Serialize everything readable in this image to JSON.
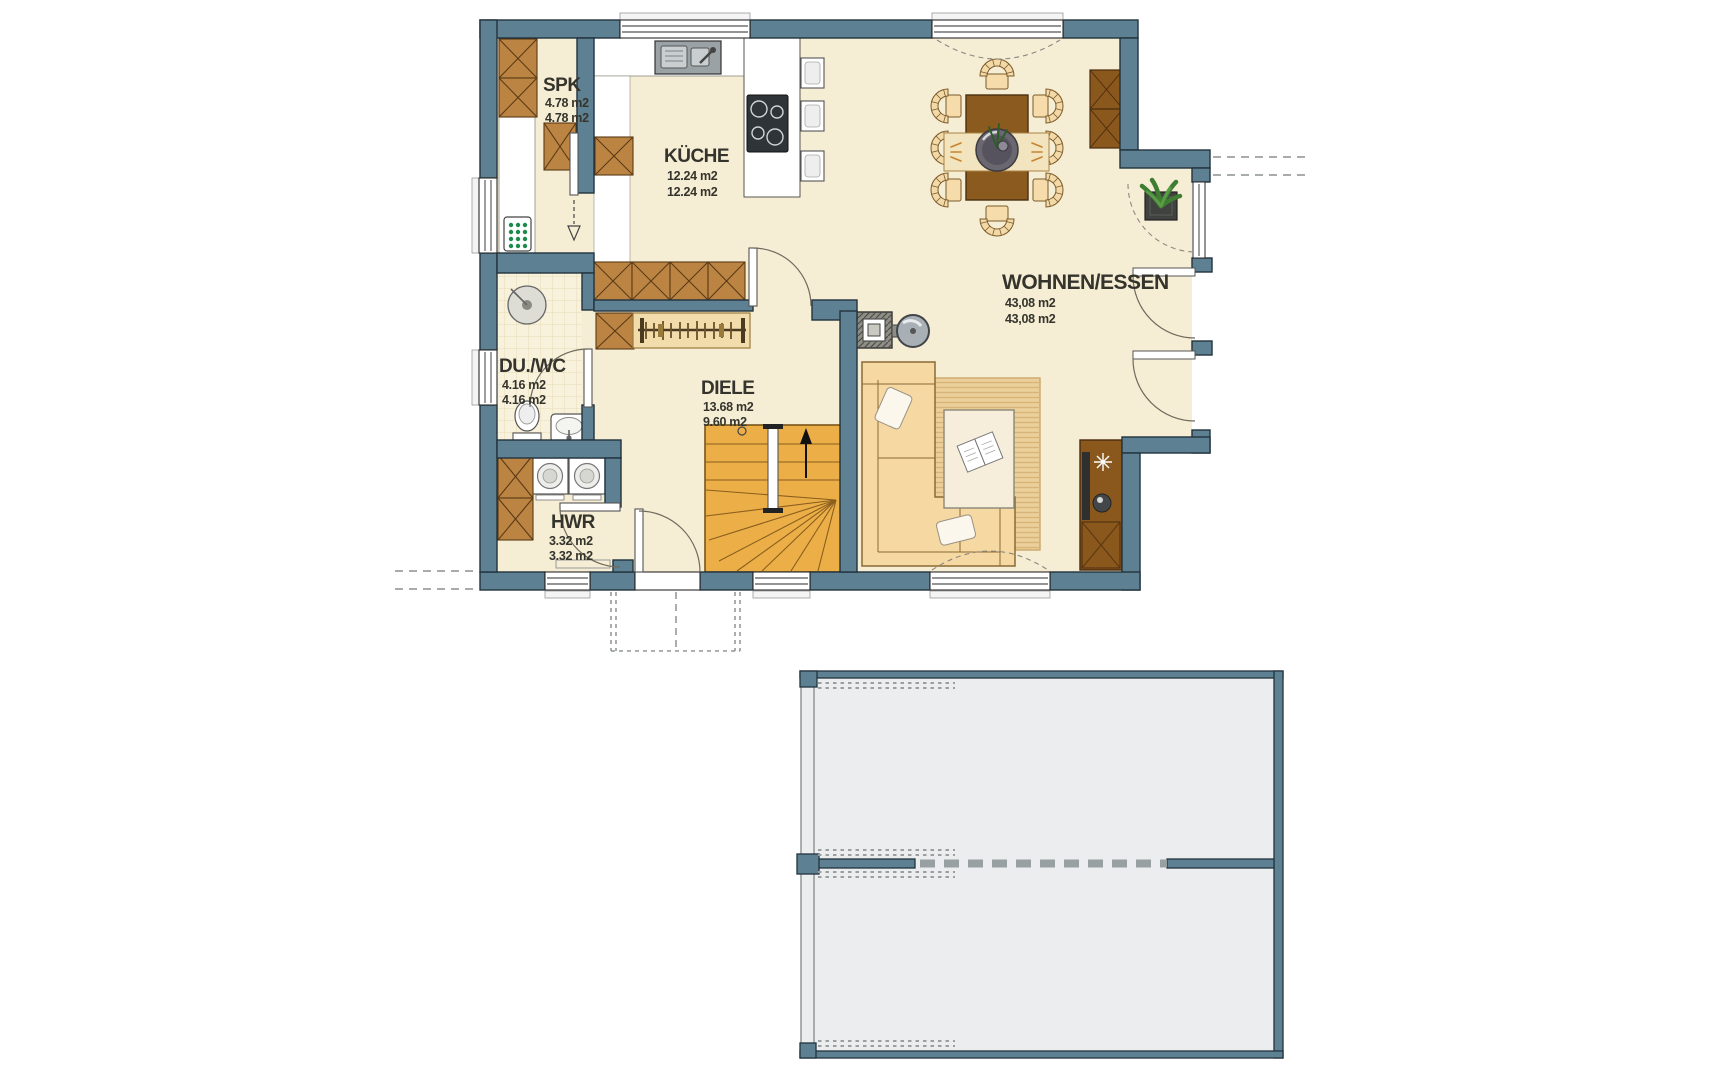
{
  "rooms": {
    "spk": {
      "name": "SPK",
      "area_line1": "4.78 m2",
      "area_line2": "4.78 m2"
    },
    "kueche": {
      "name": "KÜCHE",
      "area_line1": "12.24 m2",
      "area_line2": "12.24 m2"
    },
    "du_wc": {
      "name": "DU./WC",
      "area_line1": "4.16 m2",
      "area_line2": "4.16 m2"
    },
    "diele": {
      "name": "DIELE",
      "area_line1": "13.68 m2",
      "area_line2": "9.60 m2"
    },
    "hwr": {
      "name": "HWR",
      "area_line1": "3.32 m2",
      "area_line2": "3.32 m2"
    },
    "wohnen_essen": {
      "name": "WOHNEN/ESSEN",
      "area_line1": "43,08 m2",
      "area_line2": "43,08 m2"
    }
  },
  "colors": {
    "wall": "#5E8093",
    "outline": "#22333d",
    "floor": "#F6EDD5",
    "tile": "#F8F1DC",
    "kitchen_counter": "#FFFFFF",
    "wood_dark": "#8A5A1E",
    "wood_mid": "#BC8443",
    "soft_furniture": "#F6D8A3",
    "stairs": "#ECAF48",
    "rug": "#EBD09C",
    "garage_floor": "#ECEDEE",
    "label": "#34342C"
  }
}
